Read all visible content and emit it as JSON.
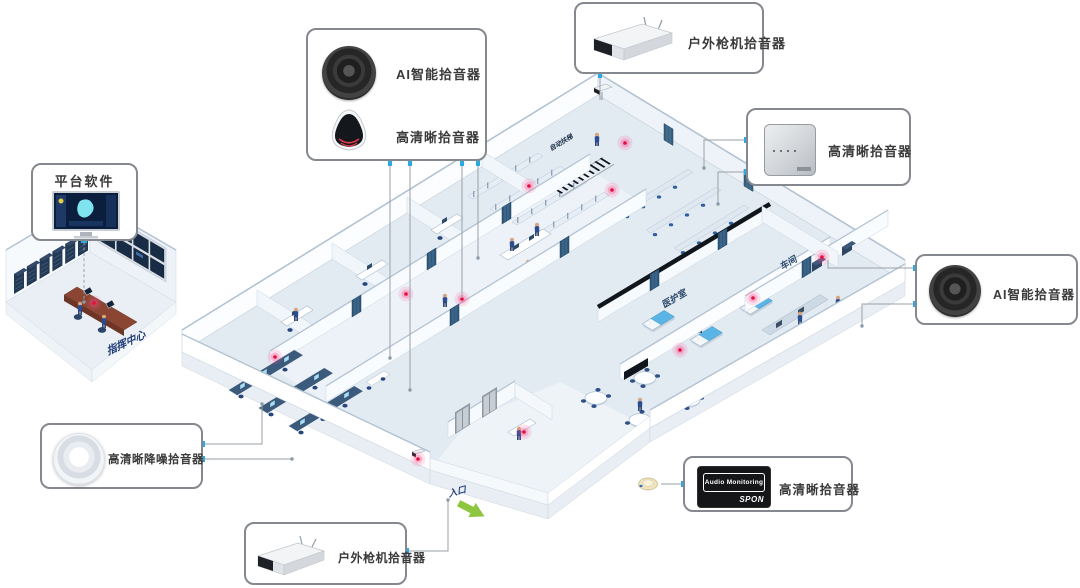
{
  "callouts": {
    "ai_smart_top": {
      "label": "AI智能拾音器"
    },
    "hd_clear_top": {
      "label": "高清晰拾音器"
    },
    "outdoor_gun_top": {
      "label": "户外枪机拾音器"
    },
    "hd_clear_right": {
      "label": "高清晰拾音器"
    },
    "ai_smart_right": {
      "label": "AI智能拾音器"
    },
    "platform_software": {
      "label": "平台软件"
    },
    "hd_noise_reduction": {
      "label": "高清晰降噪拾音器"
    },
    "outdoor_gun_bottom": {
      "label": "户外枪机拾音器"
    },
    "hd_clear_bottom": {
      "label": "高清晰拾音器",
      "device_text": "Audio Monitoring",
      "device_brand": "SPON"
    }
  },
  "building": {
    "command_center_label": "指挥中心",
    "entrance_label": "入口",
    "rooms": {
      "medical": "医护室",
      "workshop": "车间",
      "escalator": "自动扶梯",
      "switchboard": "总机室"
    }
  },
  "colors": {
    "accent_blue": "#29abe2",
    "alarm_pink": "#ff2d6d",
    "alarm_red": "#e3103f",
    "arrow_green": "#8ec63f",
    "connector_gray": "#9aa0a6",
    "callout_border": "#85898f",
    "wall_top": "#b2c2d2",
    "floor": "#e2eaf2"
  }
}
